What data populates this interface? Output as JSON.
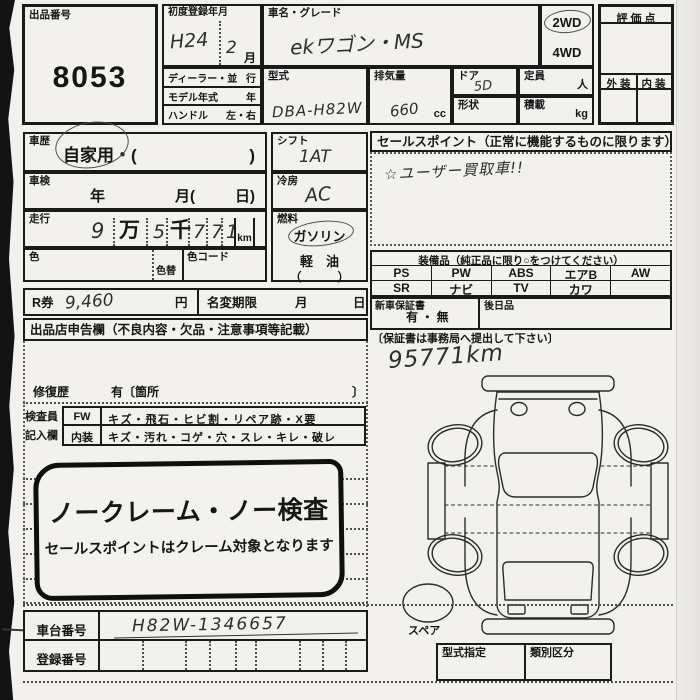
{
  "page": {
    "auction": {
      "label": "出品番号",
      "number": "8053"
    },
    "firstreg": {
      "label": "初度登録年月",
      "era": "H24",
      "month": "2",
      "month_unit": "月"
    },
    "carname": {
      "label": "車名・グレード",
      "value": "ekワゴン・MS"
    },
    "drive": {
      "wd2": "2WD",
      "wd4": "4WD"
    },
    "eval": {
      "score_label": "評 価 点",
      "ext": "外 装",
      "int": "内 装"
    },
    "dealer": {
      "r1l": "ディーラー・並",
      "r1r": "行",
      "r2l": "モデル年式",
      "r2r": "年",
      "r3l": "ハンドル",
      "r3r": "左・右"
    },
    "model": {
      "label": "型式",
      "value": "DBA-H82W"
    },
    "displacement": {
      "label": "排気量",
      "value": "660",
      "unit": "cc"
    },
    "door": {
      "label": "ドア",
      "value": "5D"
    },
    "capacity": {
      "label": "定員",
      "unit": "人"
    },
    "shape": {
      "label": "形状"
    },
    "load": {
      "label": "積載",
      "unit": "kg"
    },
    "history": {
      "label": "車歴",
      "value": "自家用・(",
      "close": ")"
    },
    "shaken": {
      "label": "車検",
      "year": "年",
      "month": "月(",
      "day": "日)"
    },
    "mileage": {
      "label": "走行",
      "digits": [
        "9",
        "万",
        "5",
        "千",
        "7",
        "7",
        "1"
      ],
      "unit": "km"
    },
    "color": {
      "label": "色",
      "change": "色替",
      "code": "色コード"
    },
    "rken": {
      "label": "R券",
      "value": "9,460",
      "unit": "円"
    },
    "namechange": {
      "label": "名変期限",
      "month": "月",
      "day": "日"
    },
    "declare": {
      "header": "出品店申告欄（不良内容・欠品・注意事項等記載）"
    },
    "repair": {
      "label": "修復歴",
      "text": "有〔箇所",
      "close": "〕"
    },
    "inspect": {
      "l1": "検査員",
      "l2": "記入欄",
      "fw": "FW",
      "fw_text": "キズ・飛石・ヒビ割・リペア跡・X要",
      "int": "内装",
      "int_text": "キズ・汚れ・コゲ・穴・スレ・キレ・破レ"
    },
    "shift": {
      "label": "シフト",
      "value": "1AT"
    },
    "aircon": {
      "label": "冷房",
      "value": "AC"
    },
    "fuel": {
      "label": "燃料",
      "gasoline": "ガソリン",
      "diesel": "軽　油",
      "paren": "（　　　）"
    },
    "sales": {
      "header": "セールスポイント（正常に機能するものに限ります）",
      "note": "☆ユーザー買取車!!"
    },
    "equipment": {
      "header": "装備品（純正品に限り○をつけてください）",
      "row1": [
        "PS",
        "PW",
        "ABS",
        "エアB",
        "AW"
      ],
      "row2": [
        "SR",
        "ナビ",
        "TV",
        "カワ",
        ""
      ]
    },
    "warranty": {
      "label": "新車保証書",
      "options": "有 ・ 無",
      "later": "後日品",
      "note": "〔保証書は事務局へ提出して下さい〕"
    },
    "notes": {
      "mileage": "95771km",
      "spare": "スペア"
    },
    "typecert": {
      "label": "型式指定",
      "class_label": "類別区分"
    },
    "stamp": {
      "line1": "ノークレーム・ノー検査",
      "line2": "セールスポイントはクレーム対象となります"
    },
    "ids": {
      "chassis_label": "車台番号",
      "chassis_value": "H82W-1346657",
      "reg_label": "登録番号"
    }
  }
}
